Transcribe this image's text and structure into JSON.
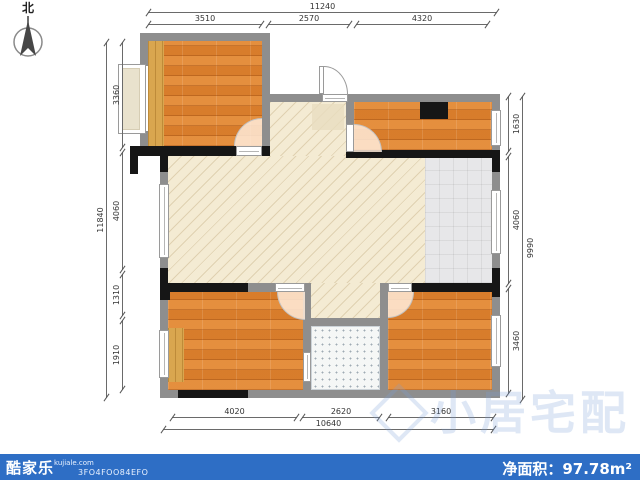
{
  "compass": {
    "north_label": "北"
  },
  "dimensions": {
    "top": {
      "overall": "11240",
      "segments": [
        "3510",
        "2570",
        "4320"
      ]
    },
    "left": {
      "overall": "11840",
      "segments": [
        "3360",
        "4060",
        "1310",
        "1910"
      ]
    },
    "right": {
      "overall": "9990",
      "segments": [
        "1630",
        "4060",
        "3460"
      ]
    },
    "bottom": {
      "overall": "10640",
      "segments": [
        "4020",
        "2620",
        "3160"
      ]
    }
  },
  "watermark": {
    "text": "小居宅配"
  },
  "footer": {
    "brand": "酷家乐",
    "site": "kujiale.com",
    "plan_code": "3FO4FOO84EFO",
    "area_label": "净面积：97.78m²"
  },
  "colors": {
    "footer_bar": "#2e6ec5",
    "wood_floor": "#e0832f",
    "living_floor": "#f4ebd3",
    "tile_floor": "#e7e7e9",
    "wall_gray": "#8e8e8e",
    "wall_black": "#161616"
  }
}
